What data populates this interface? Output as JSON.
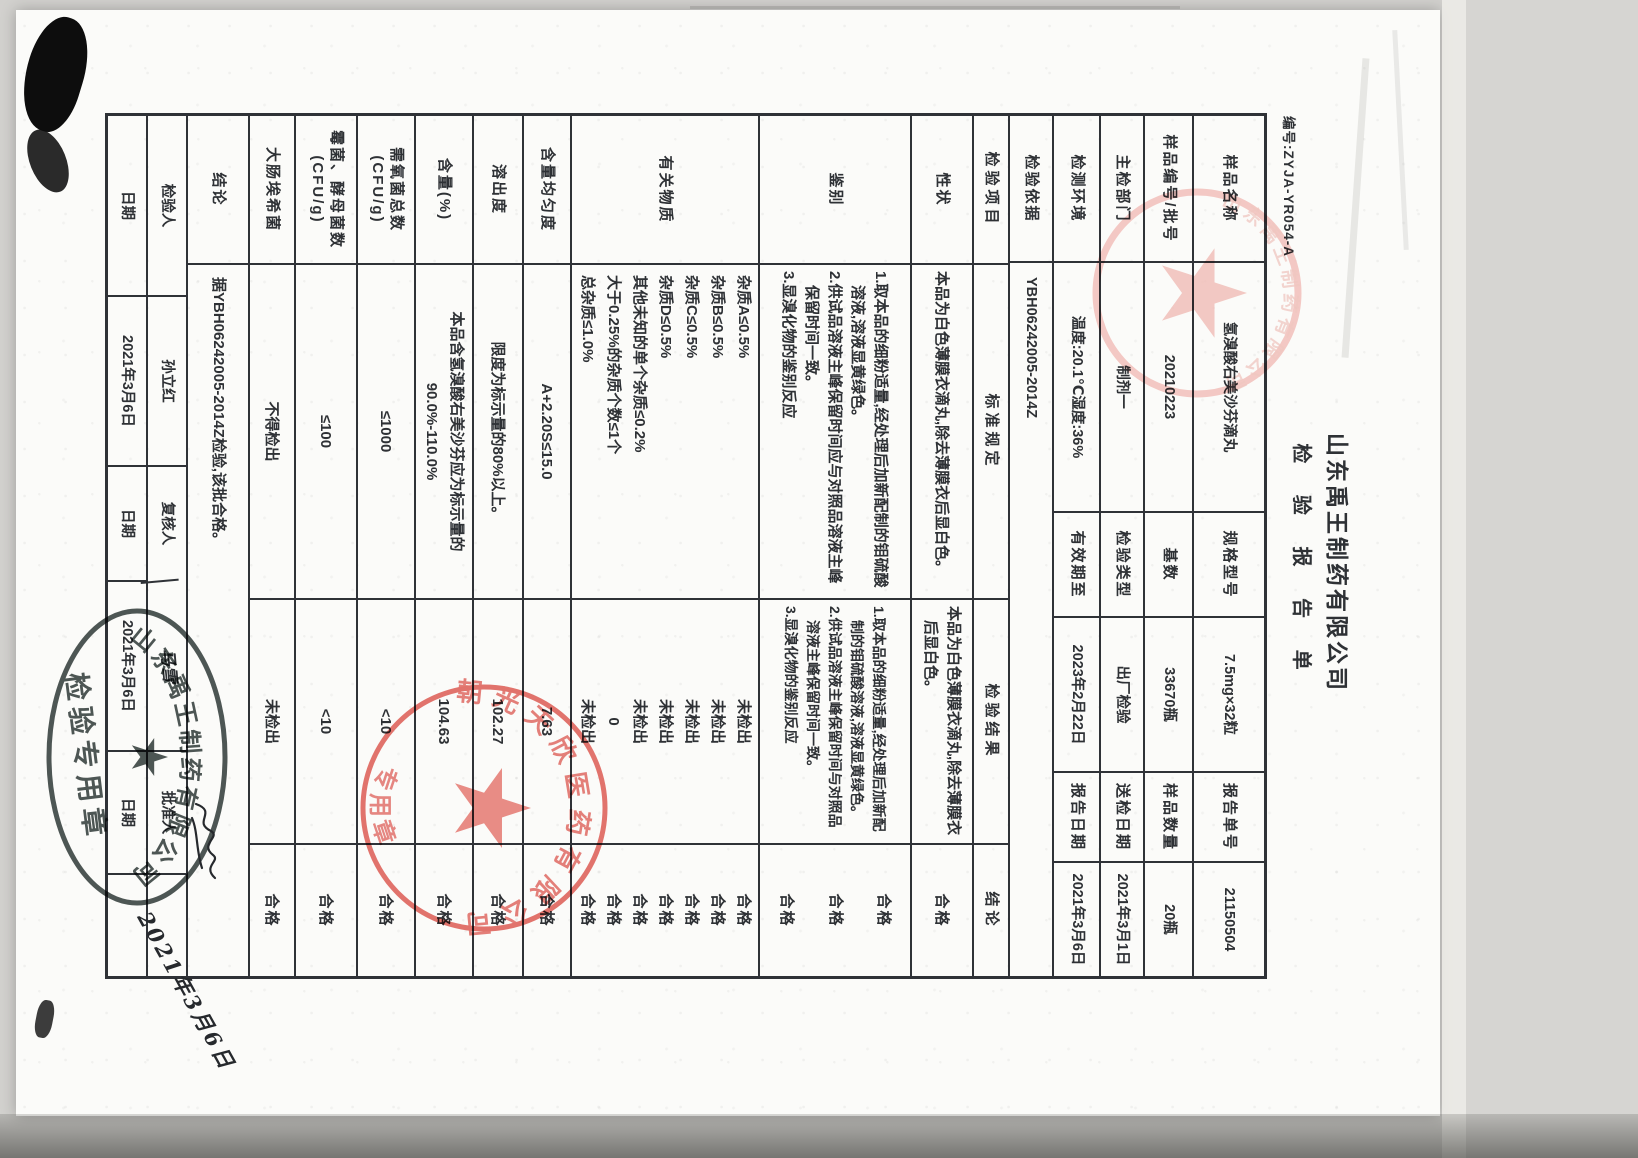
{
  "page": {
    "doc_number": "编号:ZYJA-YR054-A",
    "company": "山东禹王制药有限公司",
    "report_title": "检 验 报 告 单",
    "colors": {
      "ink": "#2e3135",
      "stamp_red": "#dd5f57",
      "stamp_pink": "#f0b9b3",
      "seal_dark": "#3e4745"
    },
    "info": {
      "rows": [
        {
          "c": [
            {
              "l": "样品名称",
              "v": "氢溴酸右美沙芬滴丸"
            },
            {
              "l": "规格型号",
              "v": "7.5mg×32粒"
            },
            {
              "l": "报告单号",
              "v": "21150504"
            }
          ]
        },
        {
          "c": [
            {
              "l": "样品编号/批号",
              "v": "20210223"
            },
            {
              "l": "基数",
              "v": "33670瓶"
            },
            {
              "l": "样品数量",
              "v": "20瓶"
            }
          ]
        },
        {
          "c": [
            {
              "l": "主检部门",
              "v": "制剂一"
            },
            {
              "l": "检验类型",
              "v": "出厂检验"
            },
            {
              "l": "送检日期",
              "v": "2021年3月1日"
            }
          ]
        },
        {
          "c": [
            {
              "l": "检测环境",
              "v": "温度:20.1℃湿度:36%"
            },
            {
              "l": "有效期至",
              "v": "2023年2月22日"
            },
            {
              "l": "报告日期",
              "v": "2021年3月6日"
            }
          ]
        }
      ],
      "basis": {
        "l": "检验依据",
        "v": "YBH06242005-2014Z"
      }
    },
    "main": {
      "headers": [
        "检验项目",
        "标准规定",
        "检验结果",
        "结论"
      ],
      "rows": [
        {
          "item": "性状",
          "standard": [
            "本品为白色薄膜衣滴丸,除去薄膜衣后显白色。"
          ],
          "result": [
            "本品为白色薄膜衣滴丸,除去薄膜衣后显白色。"
          ],
          "conclusion": [
            "合格"
          ]
        },
        {
          "item": "鉴别",
          "standard": [
            "1.取本品的细粉适量,经处理后加新配制的钼硫酸溶液,溶液显黄绿色。",
            "2.供试品溶液主峰保留时间应与对照品溶液主峰保留时间一致。",
            "3.显溴化物的鉴别反应"
          ],
          "result": [
            "1.取本品的细粉适量,经处理后加新配制的钼硫酸溶液,溶液显黄绿色。",
            "2.供试品溶液主峰保留时间与对照品溶液主峰保留时间一致。",
            "3.显溴化物的鉴别反应"
          ],
          "conclusion": [
            "合格",
            "合格",
            "合格"
          ]
        },
        {
          "item": "有关物质",
          "standard": [
            "杂质A≤0.5%",
            "杂质B≤0.5%",
            "杂质C≤0.5%",
            "杂质D≤0.5%",
            "其他未知的单个杂质≤0.2%",
            "大于0.25%的杂质个数≤1个",
            "总杂质≤1.0%"
          ],
          "result": [
            "未检出",
            "未检出",
            "未检出",
            "未检出",
            "未检出",
            "0",
            "未检出"
          ],
          "conclusion": [
            "合格",
            "合格",
            "合格",
            "合格",
            "合格",
            "合格",
            "合格"
          ]
        },
        {
          "item": "含量均匀度",
          "standard": [
            "A+2.20S≤15.0"
          ],
          "result": [
            "7.63"
          ],
          "conclusion": [
            "合格"
          ]
        },
        {
          "item": "溶出度",
          "standard": [
            "限度为标示量的80%以上。"
          ],
          "result": [
            "102.27"
          ],
          "conclusion": [
            "合格"
          ]
        },
        {
          "item": "含量(%)",
          "standard": [
            "本品含氢溴酸右美沙芬应为标示量的90.0%-110.0%"
          ],
          "result": [
            "104.63"
          ],
          "conclusion": [
            "合格"
          ]
        },
        {
          "item": "需氧菌总数(CFU/g)",
          "standard": [
            "≤1000"
          ],
          "result": [
            "<10"
          ],
          "conclusion": [
            "合格"
          ]
        },
        {
          "item": "霉菌、酵母菌数(CFU/g)",
          "standard": [
            "≤100"
          ],
          "result": [
            "<10"
          ],
          "conclusion": [
            "合格"
          ]
        },
        {
          "item": "大肠埃希菌",
          "standard": [
            "不得检出"
          ],
          "result": [
            "未检出"
          ],
          "conclusion": [
            "合格"
          ]
        }
      ],
      "final": {
        "label": "结论",
        "text": "据YBH06242005-2014Z检验,该批合格。"
      }
    },
    "signatures": {
      "rowA": [
        "检验人",
        "孙立红",
        "复核人",
        "马雪",
        "批准人",
        ""
      ],
      "rowB": [
        "日期",
        "2021年3月6日",
        "日期",
        "2021年3月6日",
        "日期",
        ""
      ]
    },
    "stamps": {
      "bottom_red": {
        "arc_text": "朝光天欣医药有限公司",
        "bottom_text": "专用章"
      },
      "oval_seal": {
        "arc_text": "山东禹王制药有限公司",
        "inner_text": "检验专用章"
      },
      "handwritten_date": "2021年3月6日"
    }
  }
}
